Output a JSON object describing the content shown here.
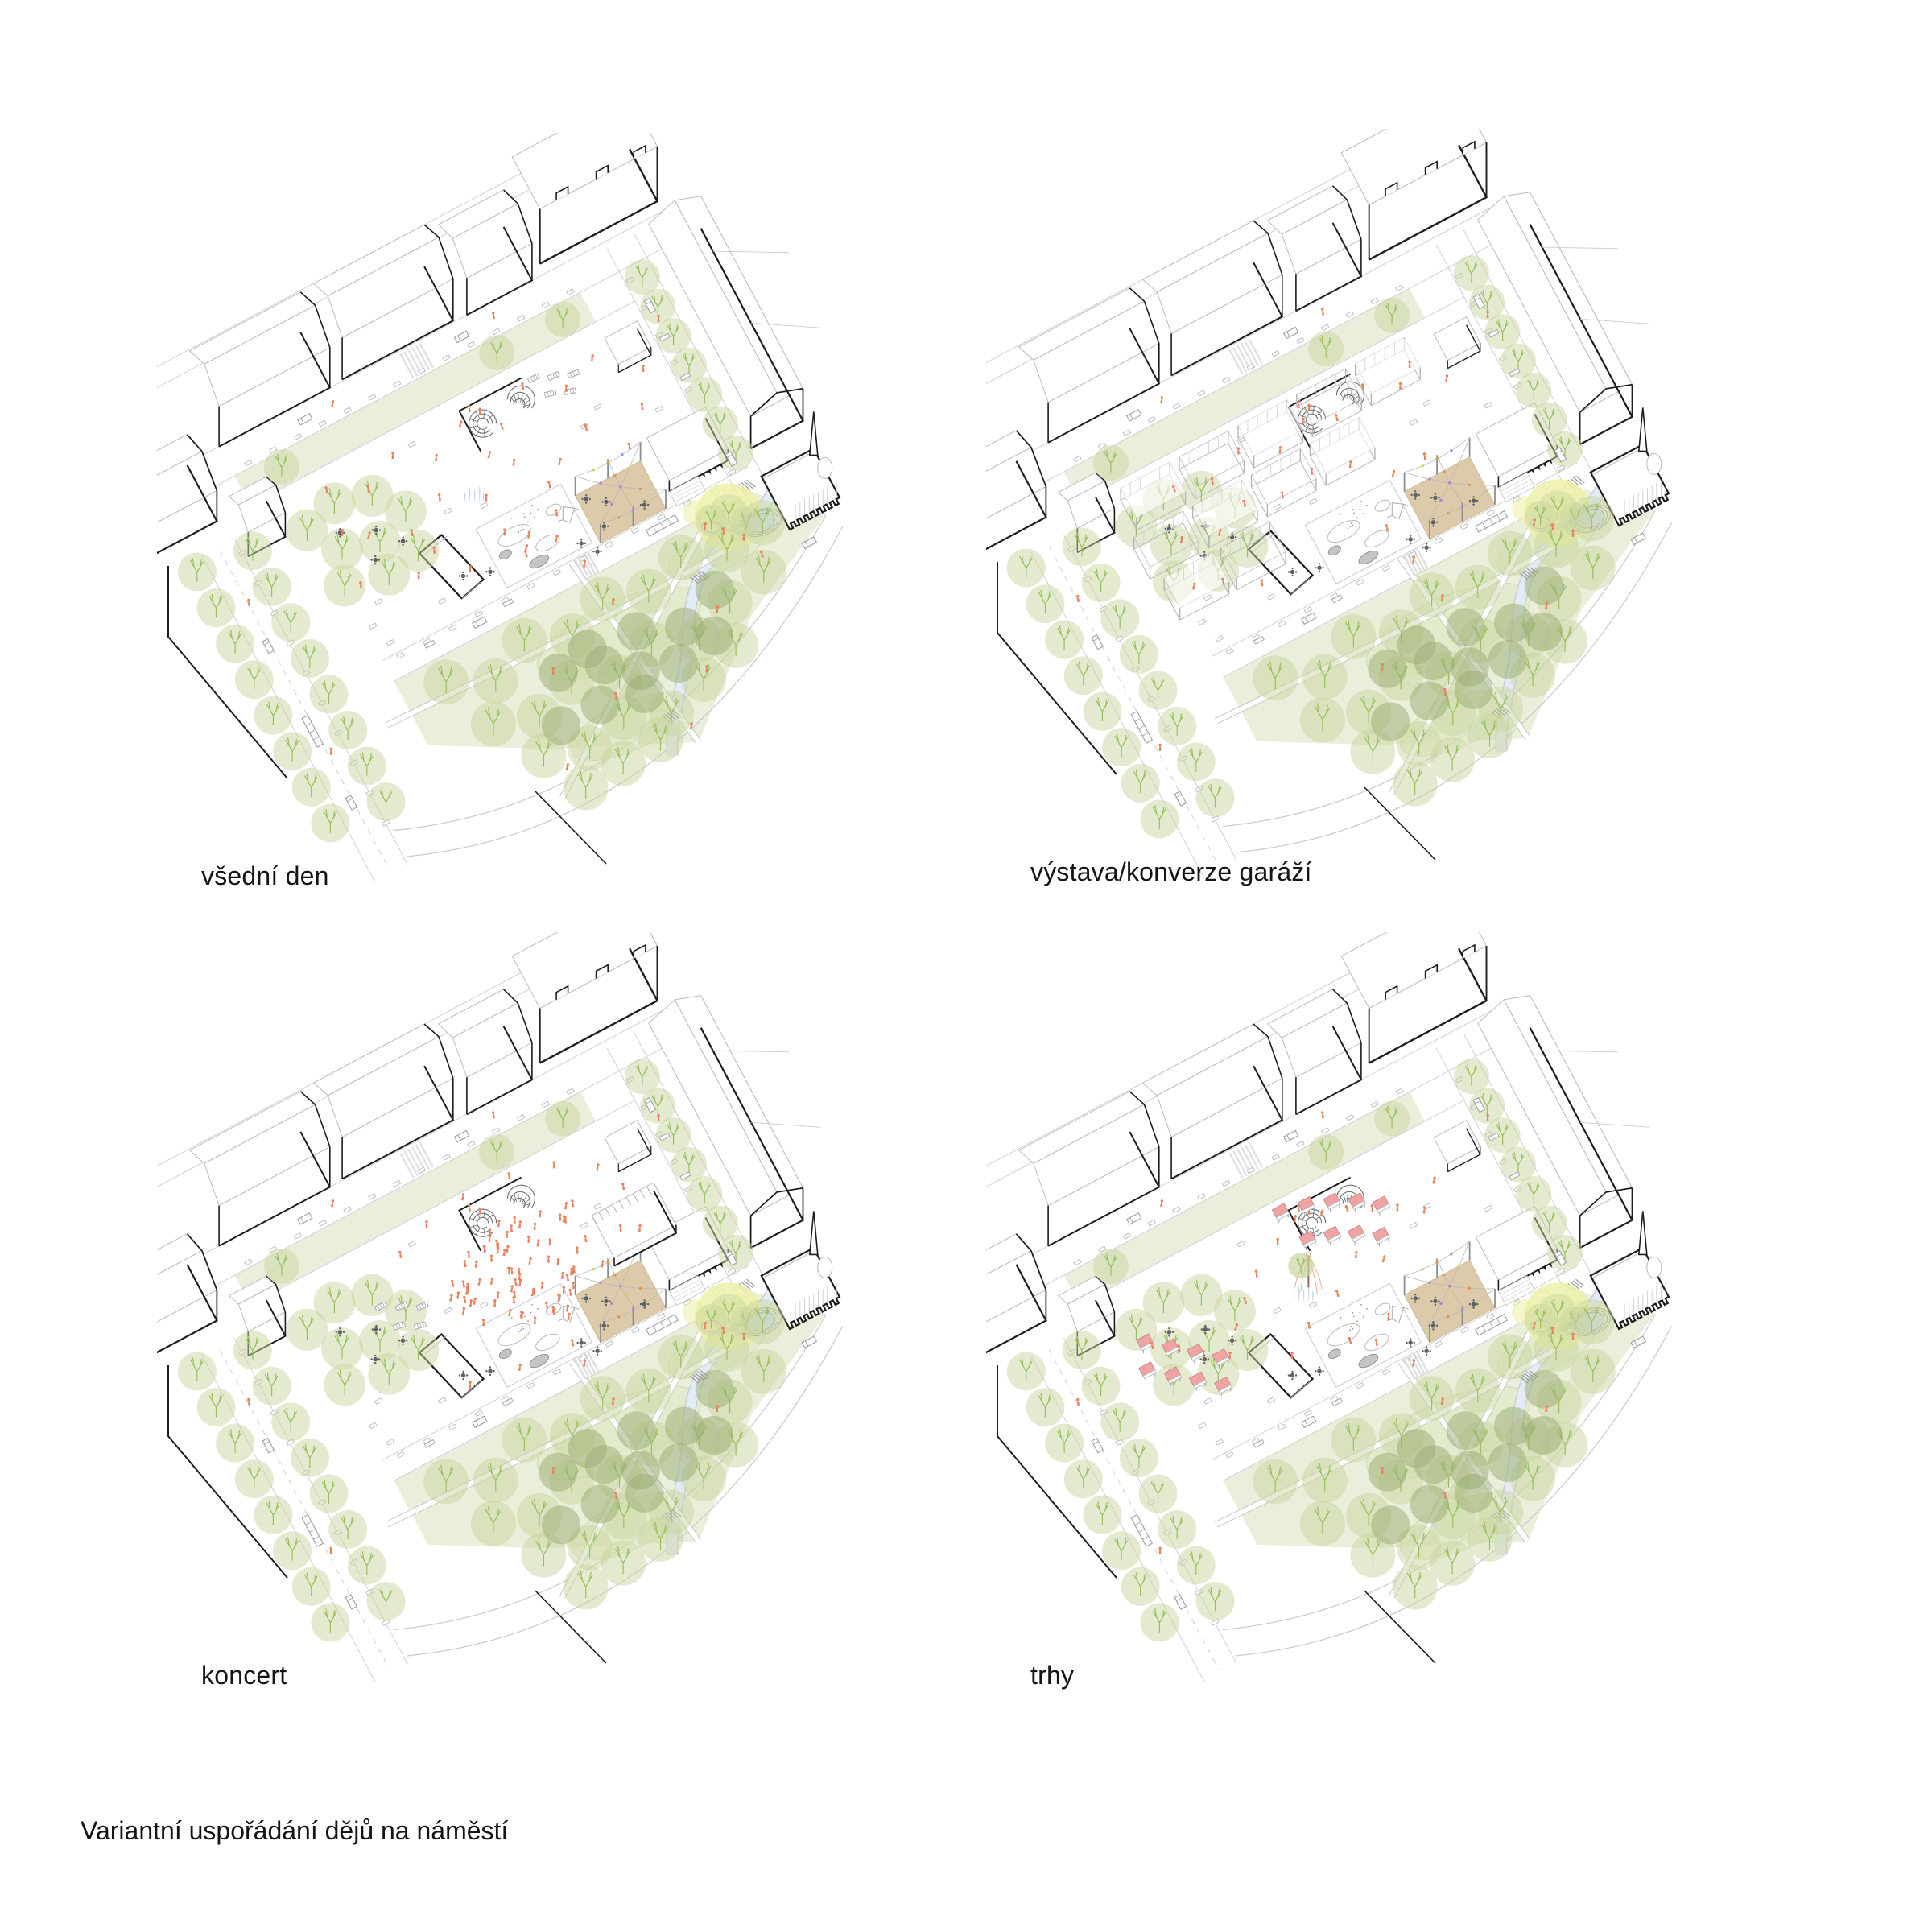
{
  "sheet": {
    "caption": "Variantní uspořádání dějů na náměstí",
    "panels": [
      {
        "id": "vsedni-den",
        "label": "všední den"
      },
      {
        "id": "vystava",
        "label": "výstava/konverze garáží"
      },
      {
        "id": "koncert",
        "label": "koncert"
      },
      {
        "id": "trhy",
        "label": "trhy"
      }
    ]
  },
  "palette": {
    "ink": "#1d1d1d",
    "line": "#b8bcc0",
    "faint": "#cdd1d4",
    "lawn": "#e9efda",
    "tree": "#c9d6a0",
    "treedark": "#9aab72",
    "branch": "#96c25c",
    "orange": "#e8825c",
    "tan": "#d9c5a2",
    "pink": "#f0a3a3",
    "water": "#cfdcf0",
    "stream": "#e3ebf5",
    "yellow": "#eef0a8",
    "bulbgreen": "#c7d45f",
    "bulbpurple": "#b77fd1",
    "furn": "#5d6166"
  }
}
